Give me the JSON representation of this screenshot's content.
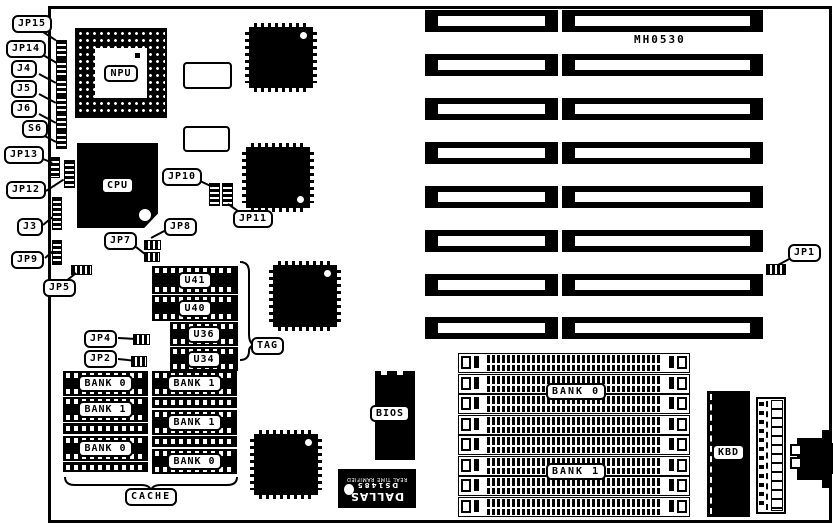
{
  "title": "MH0530",
  "jumpers": {
    "jp15": "JP15",
    "jp14": "JP14",
    "j4": "J4",
    "j5": "J5",
    "j6": "J6",
    "s6": "S6",
    "jp13": "JP13",
    "jp12": "JP12",
    "j3": "J3",
    "jp9": "JP9",
    "jp5": "JP5",
    "jp10": "JP10",
    "jp11": "JP11",
    "jp7": "JP7",
    "jp8": "JP8",
    "jp4": "JP4",
    "jp2": "JP2",
    "jp1": "JP1"
  },
  "chips": {
    "npu": "NPU",
    "cpu": "CPU",
    "u41": "U41",
    "u40": "U40",
    "u36": "U36",
    "u34": "U34",
    "bios": "BIOS",
    "kbd": "KBD"
  },
  "rtc": {
    "brand": "DALLAS",
    "part": "DS1485",
    "desc": "REAL TIME RAMIFIED"
  },
  "cache": {
    "tag": "TAG",
    "cache": "CACHE",
    "left_banks": [
      "BANK 0",
      "BANK 1",
      "BANK 0"
    ],
    "right_banks": [
      "BANK 1",
      "BANK 1",
      "BANK 0"
    ]
  },
  "memory": {
    "bank0": "BANK 0",
    "bank1": "BANK 1"
  },
  "colors": {
    "ink": "#000000",
    "paper": "#ffffff"
  }
}
